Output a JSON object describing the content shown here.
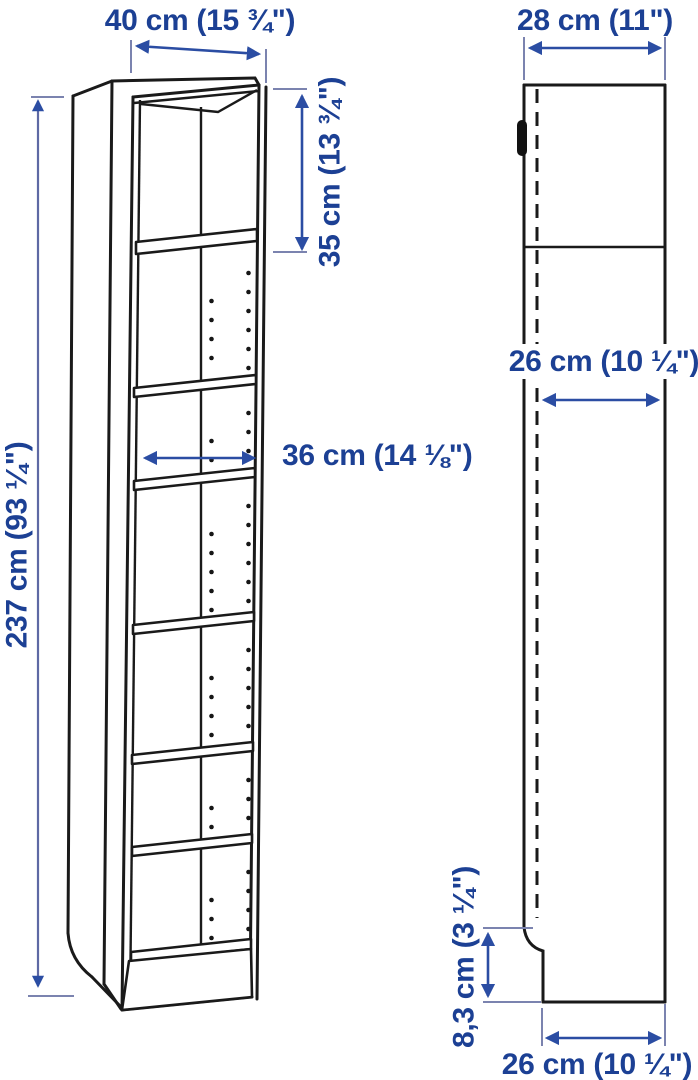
{
  "dimensions": {
    "front_width": "40 cm (15 ¾\")",
    "front_height": "237 cm (93 ¼\")",
    "top_section_height": "35 cm (13 ¾\")",
    "inner_width": "36 cm (14 ⅛\")",
    "side_depth": "28 cm (11\")",
    "inner_depth": "26 cm (10 ¼\")",
    "plinth_height": "8,3 cm (3 ¼\")",
    "base_depth": "26 cm (10 ¼\")"
  },
  "colors": {
    "dimension_text": "#1c4094",
    "arrow": "#2b4da3",
    "drawing_line": "#1a1a1a",
    "background": "#ffffff"
  }
}
